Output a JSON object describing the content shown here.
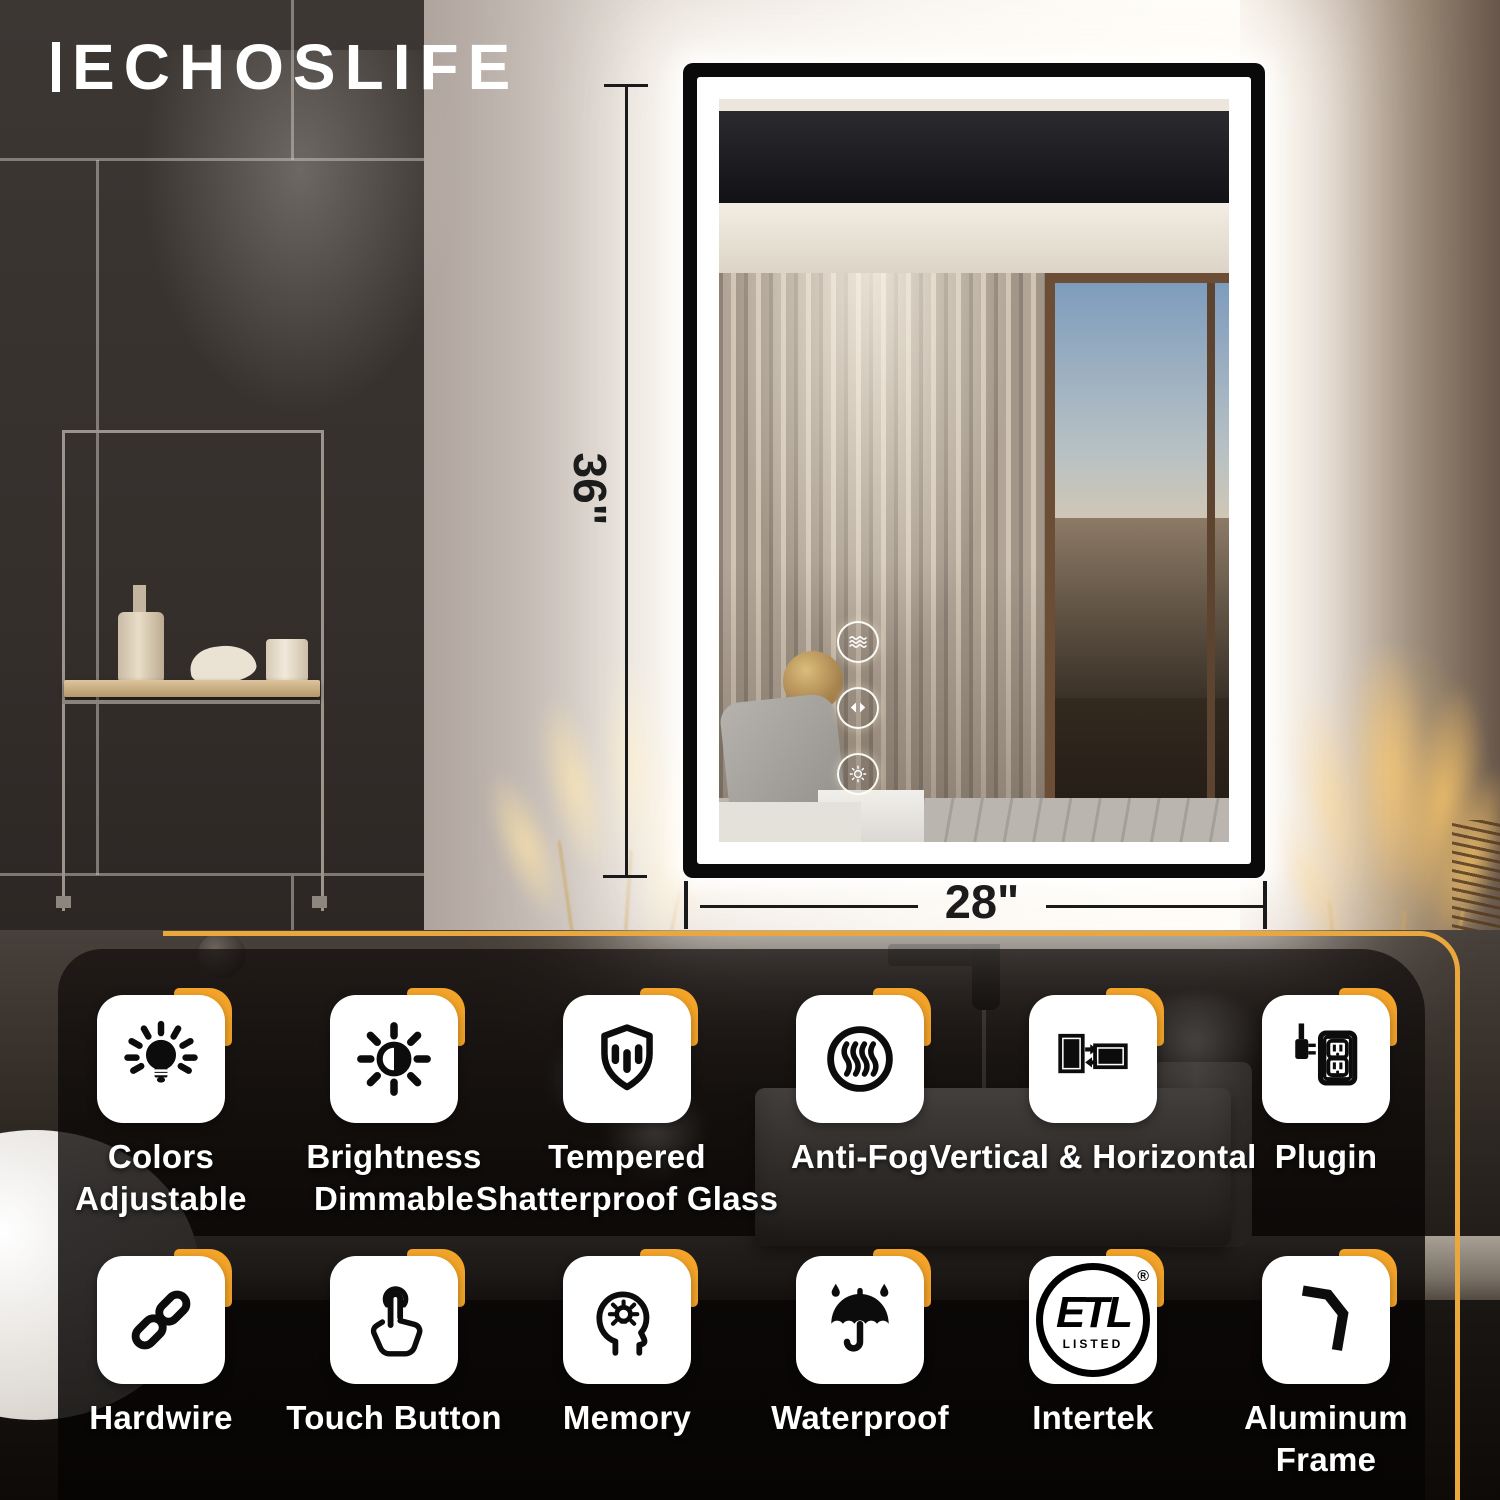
{
  "brand": {
    "logo_text": "ECHOSLIFE"
  },
  "dimensions": {
    "height": "36\"",
    "width": "28\""
  },
  "mirror": {
    "controls": [
      "anti-fog",
      "color-switch",
      "brightness"
    ]
  },
  "etl": {
    "text": "ETL",
    "listed": "LISTED",
    "reg": "®"
  },
  "features": [
    {
      "label": "Colors\nAdjustable",
      "icon": "bulb-color-icon"
    },
    {
      "label": "Brightness\nDimmable",
      "icon": "brightness-icon"
    },
    {
      "label": "Tempered\nShatterproof Glass",
      "icon": "shield-glass-icon"
    },
    {
      "label": "Anti-Fog",
      "icon": "anti-fog-icon"
    },
    {
      "label": "Vertical & Horizontal",
      "icon": "orientation-icon"
    },
    {
      "label": "Plugin",
      "icon": "plug-outlet-icon"
    },
    {
      "label": "Hardwire",
      "icon": "chain-link-icon"
    },
    {
      "label": "Touch Button",
      "icon": "touch-hand-icon"
    },
    {
      "label": "Memory",
      "icon": "memory-head-icon"
    },
    {
      "label": "Waterproof",
      "icon": "umbrella-rain-icon"
    },
    {
      "label": "Intertek",
      "icon": "etl-listed-icon"
    },
    {
      "label": "Aluminum\nFrame",
      "icon": "frame-corner-icon"
    }
  ],
  "colors": {
    "accent_orange": "#F3A429",
    "outline_gold": "#EAA73D",
    "frame_black": "#0A0A0A",
    "led_white": "#FFFFFF"
  }
}
